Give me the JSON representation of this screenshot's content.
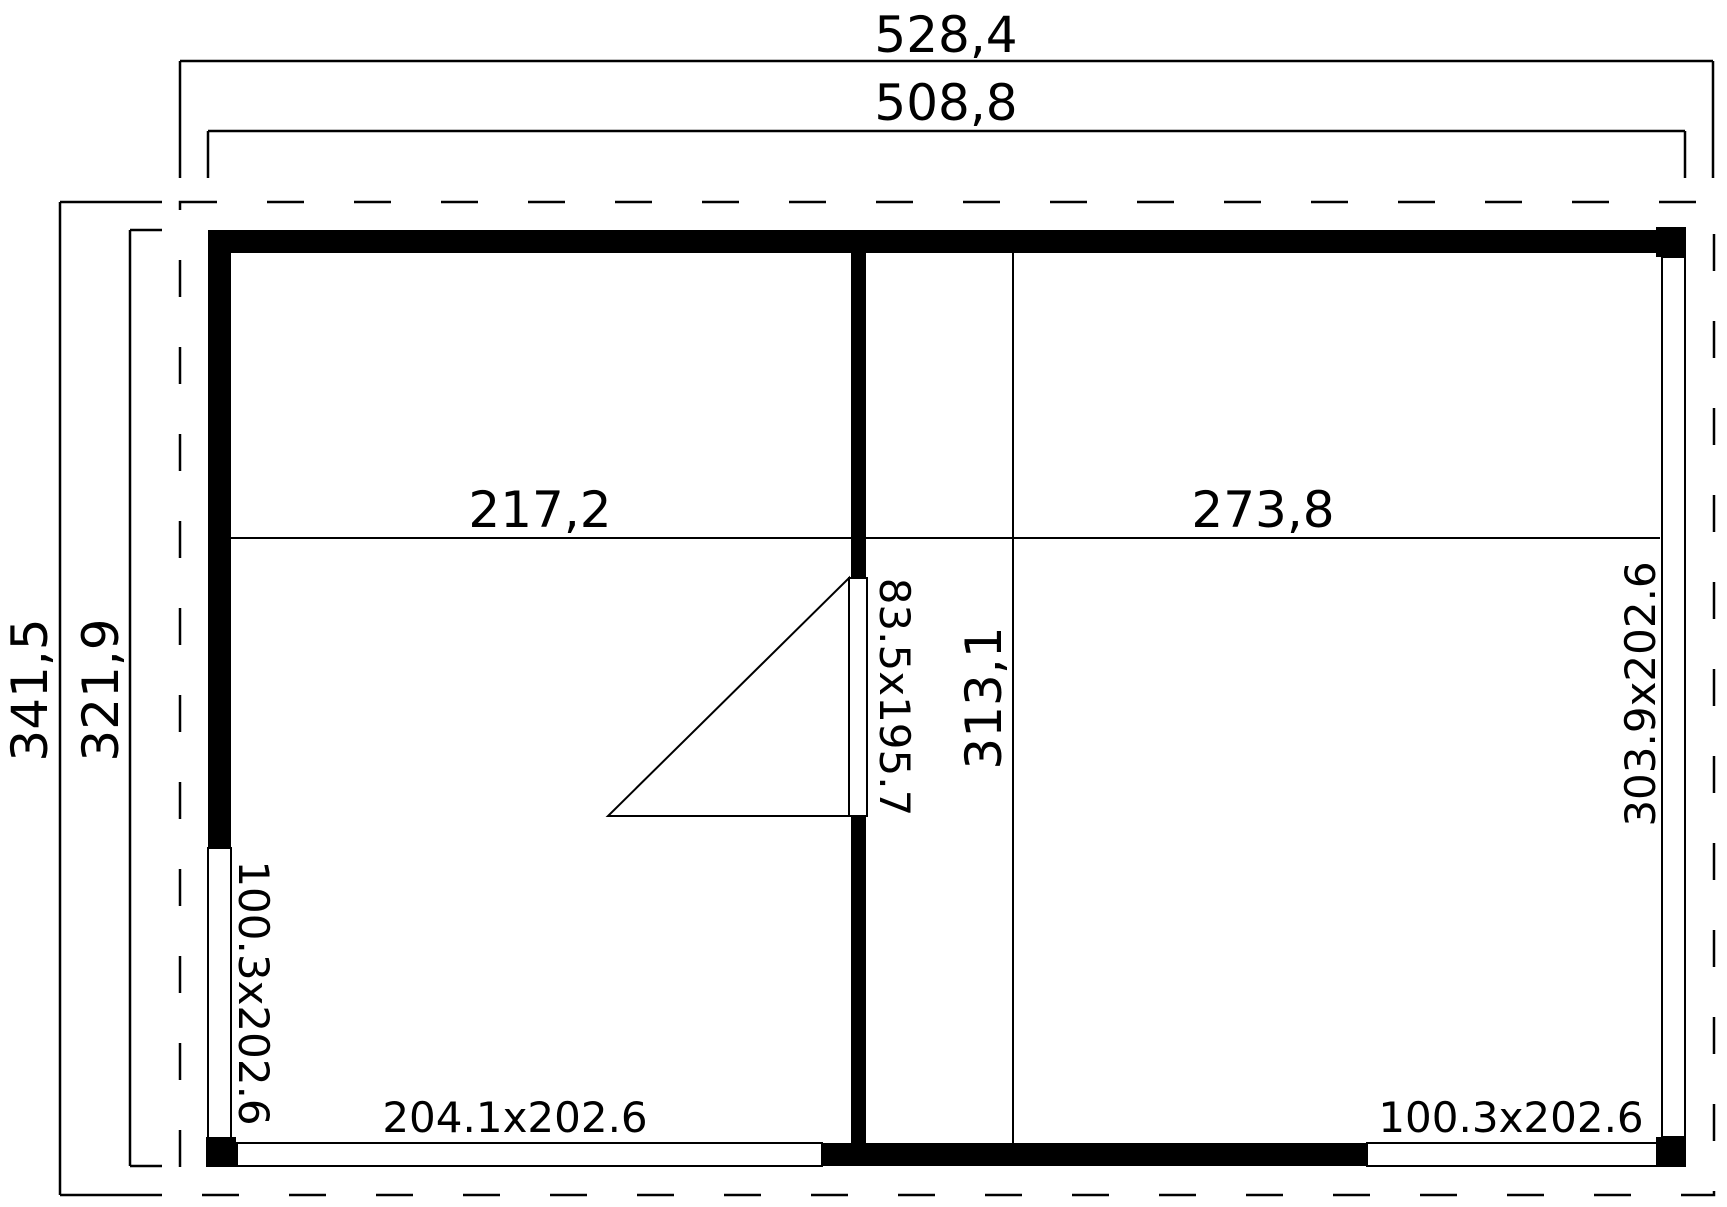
{
  "drawing": {
    "type": "garden-house floor plan, top view",
    "colors": {
      "line": "#000000",
      "wall_fill": "#000000",
      "background": "#ffffff"
    }
  },
  "dimensions": {
    "roof_width": "528,4",
    "building_width": "508,8",
    "roof_depth": "341,5",
    "building_depth": "321,9"
  },
  "rooms": {
    "left_width": "217,2",
    "right_width": "273,8",
    "interior_depth": "313,1"
  },
  "openings": {
    "door_size": "83.5x195.7",
    "left_window_size": "100.3x202.6",
    "bottom_left_window_size": "204.1x202.6",
    "bottom_right_window_size": "100.3x202.6",
    "right_window_size": "303.9x202.6"
  }
}
